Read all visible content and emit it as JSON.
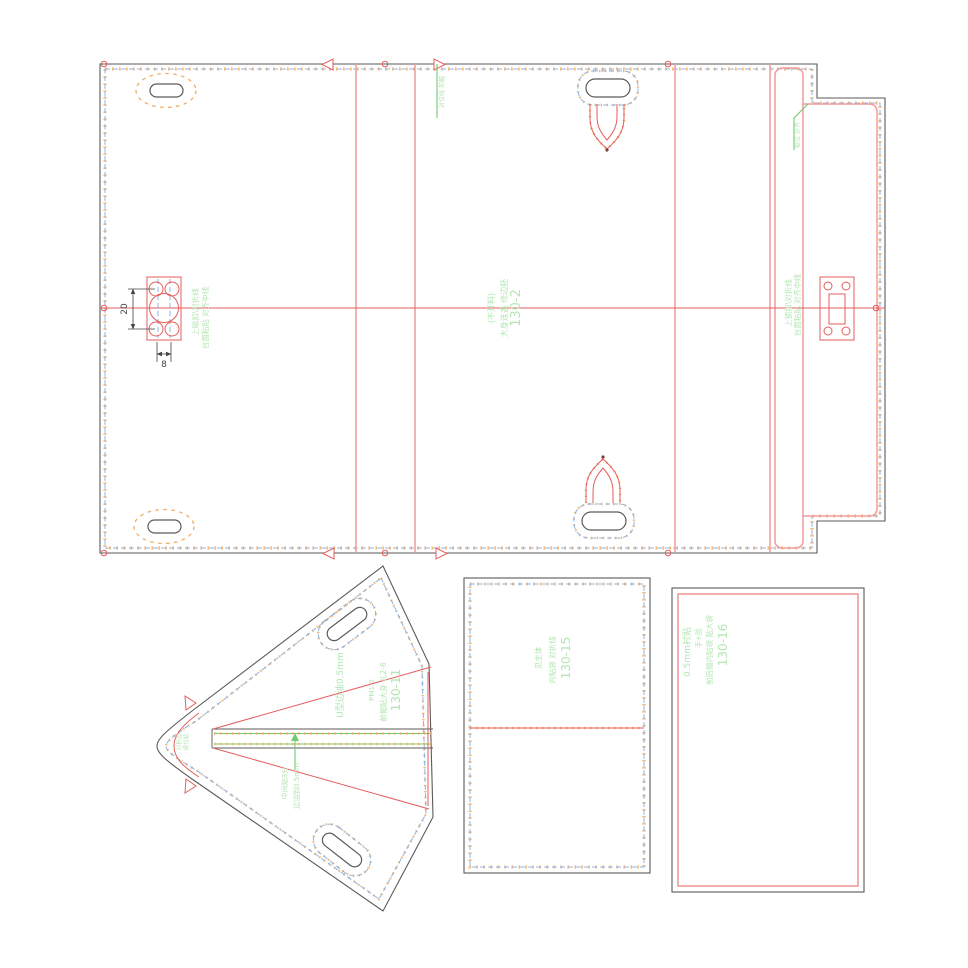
{
  "palette": {
    "outline": "#5a5a5a",
    "stitch": "#8fb4e3",
    "tick": "#f0ab62",
    "red": "#e55d5d",
    "pink": "#f29b9b",
    "gline": "#72c972",
    "gtext": "#b3e6b3",
    "dim": "#454545"
  },
  "pieces": {
    "main": {
      "part_no": "130-2",
      "material_note": "大身连盖 修边胚",
      "cut_note": "(不开料)",
      "magnet_note_a": "上磁扣\\对折线",
      "magnet_note_b": "台面粘贴 对齐中线",
      "lock_note_a": "上锁扣\\对折线",
      "lock_note_b": "台面粘贴 对齐中线",
      "top_edge_note": "对位线 前幅",
      "flap_note": "贴位 对齐",
      "dim_height": "20",
      "dim_width": "8"
    },
    "gusset": {
      "part_no": "130-11",
      "note_attach": "前幅贴大身 扎2-6",
      "note_pm": "PM1.0",
      "note_u_edge": "U型边油0.5mm",
      "band_note_a": "中间贴3分",
      "band_note_b": "边油到0.5mm",
      "tip_note_a": "对折边",
      "tip_note_b": "按位粘"
    },
    "pocket": {
      "part_no": "130-15",
      "note_a": "内贴袋 对折线",
      "note_b": "见主体"
    },
    "lining": {
      "part_no": "130-16",
      "note_a": "前后幅内贴袋 贴大袋",
      "note_b": "手+胶",
      "note_c": "0.5mm衬贴"
    }
  }
}
